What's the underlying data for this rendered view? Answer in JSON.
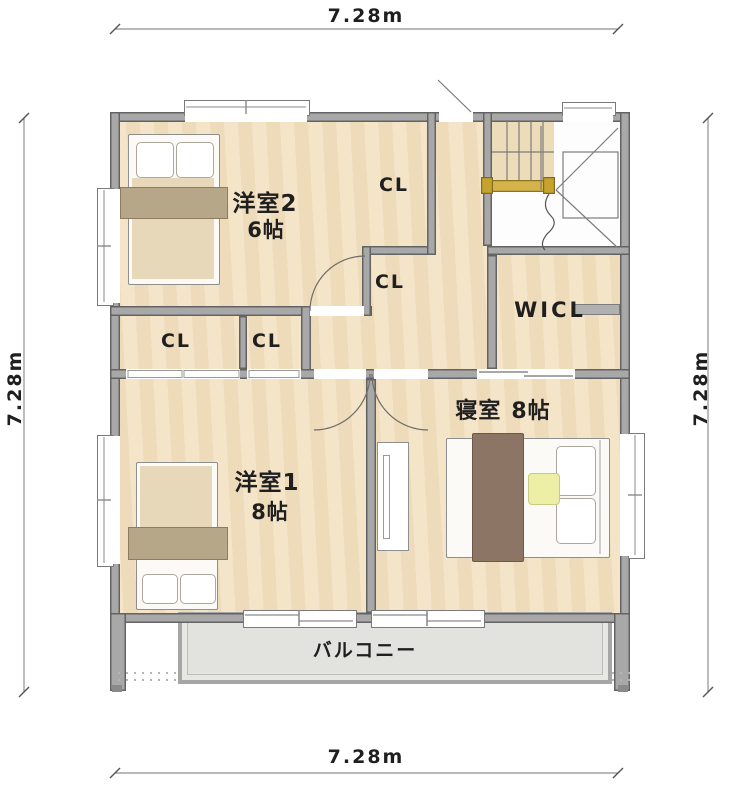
{
  "plan": {
    "title": "2F間取り図",
    "dim_top": "7.28m",
    "dim_bottom": "7.28m",
    "dim_left": "7.28m",
    "dim_right": "7.28m",
    "rooms": {
      "yoshitsu2": {
        "name": "洋室2",
        "size": "6帖"
      },
      "yoshitsu1": {
        "name": "洋室1",
        "size": "8帖"
      },
      "bedroom": {
        "name": "寝室",
        "size": "8帖"
      },
      "wicl": {
        "name": "WICL"
      },
      "balcony": {
        "name": "バルコニー"
      }
    },
    "closets": {
      "cl1": "CL",
      "cl2": "CL",
      "cl3": "CL",
      "cl4": "CL"
    }
  },
  "colors": {
    "floor": "#f2e0c1",
    "wall": "#a8a8a8",
    "wall_edge": "#636363",
    "blanket_light": "#e7d8ba",
    "blanket_band": "#b7a789",
    "bedroom_blanket": "#8d7565",
    "stair_rail_gold": "#d4b44a",
    "cushion_yellow": "#ecefa5",
    "balcony_floor": "#e7e7e3"
  }
}
